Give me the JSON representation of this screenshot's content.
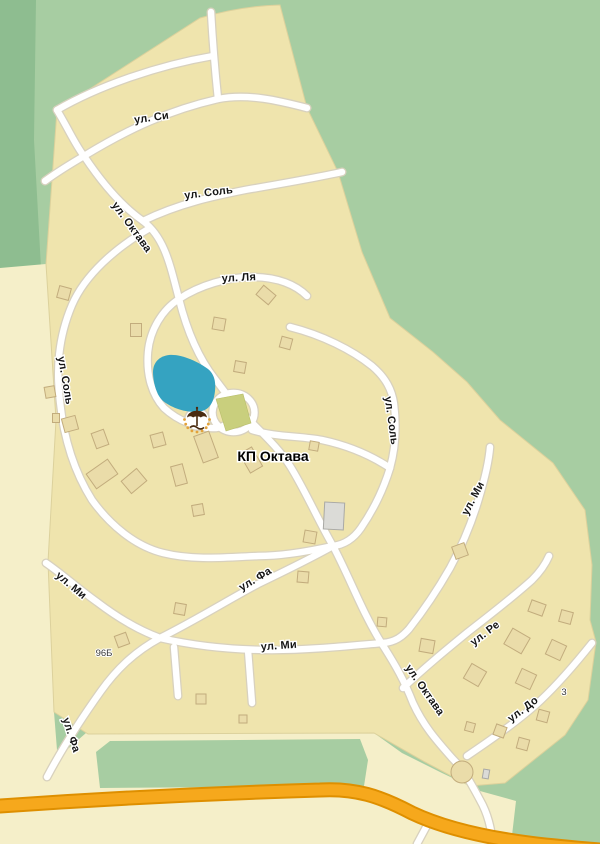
{
  "map": {
    "settlement_name": "КП Октава",
    "streets": [
      "ул. Октава",
      "ул. Си",
      "ул. Соль",
      "ул. Ля",
      "ул. Ми",
      "ул. Фа",
      "ул. Ре",
      "ул. До"
    ],
    "labels": {
      "si": "ул. Си",
      "sol_north": "ул. Соль",
      "lya": "ул. Ля",
      "oktava_top": "ул. Октава",
      "sol_west": "ул. Соль",
      "sol_east": "ул. Соль",
      "mi_right": "ул. Ми",
      "mi_nw": "ул. Ми",
      "fa_ne": "ул. Фа",
      "mi_center": "ул. Ми",
      "oktava_bottom": "ул. Октава",
      "re": "ул. Ре",
      "do_street": "ул. До",
      "fa_sw": "ул. Фа",
      "settlement": "КП Октава",
      "plot_96b": "96Б",
      "plot_3": "3"
    },
    "icons": {
      "beach": "beach-umbrella-icon"
    },
    "colors": {
      "background_green": "#A7CDA2",
      "forest_dark_green": "#8EBD90",
      "field_cream": "#F5EFC9",
      "settlement_beige": "#EFE4AD",
      "settlement_edge": "#DCD19C",
      "road_white": "#FFFFFF",
      "road_casing": "#D8D1BE",
      "highway_orange": "#F6A81C",
      "highway_casing": "#DE8F00",
      "pond_blue": "#35A3C1",
      "lawn_green": "#C9CF7D",
      "sand_yellow": "#E8A93C",
      "building_tan": "#EADCA9",
      "building_gray": "#DBDBD7",
      "umbrella_brown": "#4A2B10",
      "label_black": "#151515"
    },
    "buildings": {
      "tan": [
        [
          64,
          293,
          12,
          12,
          15
        ],
        [
          136,
          330,
          11,
          13,
          0
        ],
        [
          219,
          324,
          12,
          12,
          10
        ],
        [
          266,
          295,
          16,
          12,
          40
        ],
        [
          286,
          343,
          11,
          11,
          15
        ],
        [
          240,
          367,
          11,
          11,
          10
        ],
        [
          158,
          440,
          13,
          13,
          -15
        ],
        [
          50,
          392,
          10,
          11,
          -10
        ],
        [
          56,
          418,
          7,
          9,
          0
        ],
        [
          70,
          424,
          14,
          14,
          -15
        ],
        [
          100,
          439,
          13,
          16,
          -20
        ],
        [
          102,
          474,
          26,
          18,
          -35
        ],
        [
          134,
          481,
          20,
          16,
          -40
        ],
        [
          179,
          475,
          12,
          20,
          -15
        ],
        [
          198,
          510,
          11,
          11,
          -10
        ],
        [
          206,
          447,
          16,
          28,
          -20
        ],
        [
          251,
          460,
          14,
          22,
          -30
        ],
        [
          314,
          446,
          9,
          9,
          10
        ],
        [
          310,
          537,
          12,
          12,
          10
        ],
        [
          303,
          577,
          11,
          11,
          5
        ],
        [
          180,
          609,
          11,
          11,
          10
        ],
        [
          122,
          640,
          12,
          12,
          -20
        ],
        [
          201,
          699,
          10,
          10,
          0
        ],
        [
          243,
          719,
          8,
          8,
          0
        ],
        [
          382,
          622,
          9,
          9,
          5
        ],
        [
          427,
          646,
          14,
          13,
          10
        ],
        [
          460,
          551,
          13,
          13,
          -20
        ],
        [
          537,
          608,
          15,
          12,
          20
        ],
        [
          566,
          617,
          12,
          12,
          15
        ],
        [
          517,
          641,
          20,
          18,
          30
        ],
        [
          475,
          675,
          17,
          17,
          30
        ],
        [
          526,
          679,
          16,
          16,
          25
        ],
        [
          556,
          650,
          16,
          16,
          25
        ],
        [
          500,
          731,
          11,
          11,
          20
        ],
        [
          543,
          716,
          11,
          11,
          15
        ],
        [
          470,
          727,
          9,
          9,
          15
        ],
        [
          523,
          744,
          11,
          11,
          15
        ]
      ],
      "gray": [
        [
          334,
          516,
          20,
          27,
          3
        ],
        [
          486,
          774,
          6,
          9,
          10
        ]
      ],
      "round": [
        [
          462,
          772,
          11
        ]
      ]
    }
  }
}
